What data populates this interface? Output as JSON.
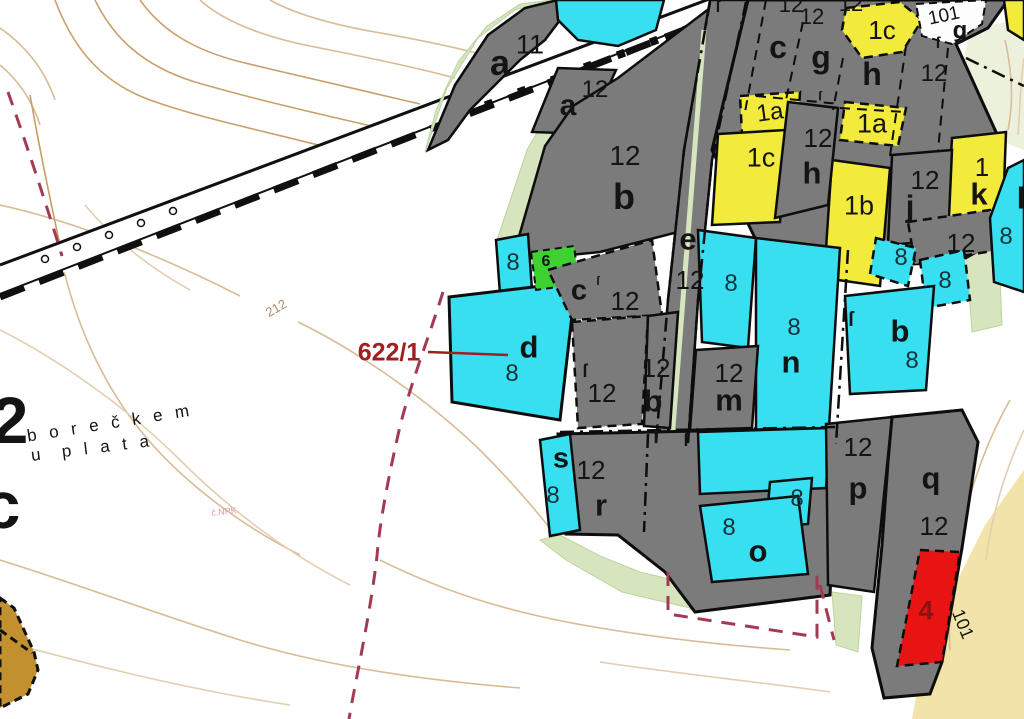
{
  "map": {
    "type": "cadastral-map",
    "callout": {
      "text": "622/1",
      "color": "#9e1f1f"
    },
    "palette": {
      "parcel_gray": "#7b7b7b",
      "parcel_cyan": "#38dff1",
      "parcel_yellow": "#f3eb3b",
      "parcel_green": "#3ed230",
      "parcel_red": "#e81414",
      "parcel_brown": "#c2902e",
      "parcel_white": "#fdfdfd",
      "contour_tan": "#c9a06c",
      "boundary_maroon": "#a23a52",
      "strip_lightgreen": "#d7e5bf",
      "area_paleyellow": "#f2e3a9",
      "number_on_cyan": "#17323c"
    },
    "labels": [
      {
        "name": "parcel-letter-a11",
        "text": "a",
        "x": 500,
        "y": 63,
        "size": 36,
        "w": 700
      },
      {
        "name": "parcel-number-11",
        "text": "11",
        "x": 530,
        "y": 45,
        "size": 27,
        "w": 400
      },
      {
        "name": "parcel-letter-a12",
        "text": "a",
        "x": 568,
        "y": 106,
        "size": 30,
        "w": 700
      },
      {
        "name": "parcel-number-12-a12",
        "text": "12",
        "x": 595,
        "y": 90,
        "size": 24,
        "w": 400
      },
      {
        "name": "parcel-number-12-b-top",
        "text": "12",
        "x": 625,
        "y": 156,
        "size": 28,
        "w": 400
      },
      {
        "name": "parcel-letter-b-top",
        "text": "b",
        "x": 624,
        "y": 197,
        "size": 36,
        "w": 700
      },
      {
        "name": "parcel-letter-c-top",
        "text": "c",
        "x": 778,
        "y": 47,
        "size": 32,
        "w": 700
      },
      {
        "name": "parcel-letter-g-top",
        "text": "g",
        "x": 821,
        "y": 57,
        "size": 32,
        "w": 700
      },
      {
        "name": "parcel-number-12-top-a",
        "text": "12",
        "x": 791,
        "y": 5,
        "size": 22,
        "w": 400
      },
      {
        "name": "parcel-number-12-top-b",
        "text": "12",
        "x": 851,
        "y": 4,
        "size": 22,
        "w": 400
      },
      {
        "name": "parcel-number-12-top-c",
        "text": "12",
        "x": 812,
        "y": 17,
        "size": 22,
        "w": 400
      },
      {
        "name": "parcel-label-1c-top",
        "text": "1c",
        "x": 882,
        "y": 30,
        "size": 26,
        "w": 400
      },
      {
        "name": "parcel-number-101-top",
        "text": "101",
        "x": 944,
        "y": 16,
        "size": 19,
        "w": 400,
        "rot": -12
      },
      {
        "name": "parcel-letter-g-101",
        "text": "g",
        "x": 960,
        "y": 31,
        "size": 24,
        "w": 700
      },
      {
        "name": "parcel-letter-h-top",
        "text": "h",
        "x": 872,
        "y": 74,
        "size": 32,
        "w": 700
      },
      {
        "name": "parcel-number-12-right-top",
        "text": "12",
        "x": 934,
        "y": 74,
        "size": 24,
        "w": 400
      },
      {
        "name": "parcel-label-1a-left",
        "text": "1a",
        "x": 770,
        "y": 113,
        "size": 24,
        "w": 400,
        "rot": -8
      },
      {
        "name": "parcel-number-12-h",
        "text": "12",
        "x": 818,
        "y": 138,
        "size": 26,
        "w": 400
      },
      {
        "name": "parcel-label-1a-right",
        "text": "1a",
        "x": 872,
        "y": 124,
        "size": 27,
        "w": 400
      },
      {
        "name": "parcel-label-1c-mid",
        "text": "1c",
        "x": 761,
        "y": 158,
        "size": 27,
        "w": 400
      },
      {
        "name": "parcel-letter-h-mid",
        "text": "h",
        "x": 812,
        "y": 173,
        "size": 31,
        "w": 700
      },
      {
        "name": "parcel-label-1b",
        "text": "1b",
        "x": 859,
        "y": 206,
        "size": 27,
        "w": 400
      },
      {
        "name": "parcel-number-12-j",
        "text": "12",
        "x": 925,
        "y": 180,
        "size": 26,
        "w": 400
      },
      {
        "name": "parcel-letter-j",
        "text": "j",
        "x": 910,
        "y": 206,
        "size": 31,
        "w": 700
      },
      {
        "name": "parcel-number-1-k",
        "text": "1",
        "x": 982,
        "y": 167,
        "size": 26,
        "w": 400
      },
      {
        "name": "parcel-letter-k",
        "text": "k",
        "x": 979,
        "y": 194,
        "size": 31,
        "w": 700
      },
      {
        "name": "parcel-letter-l",
        "text": "l",
        "x": 1021,
        "y": 198,
        "size": 31,
        "w": 700
      },
      {
        "name": "parcel-number-12-right",
        "text": "12",
        "x": 961,
        "y": 243,
        "size": 26,
        "w": 400
      },
      {
        "name": "parcel-number-8-r1",
        "text": "8",
        "x": 901,
        "y": 258,
        "size": 24,
        "w": 400,
        "color": "#17323c"
      },
      {
        "name": "parcel-number-8-r2",
        "text": "8",
        "x": 945,
        "y": 281,
        "size": 24,
        "w": 400,
        "color": "#17323c"
      },
      {
        "name": "parcel-number-8-edge",
        "text": "8",
        "x": 1006,
        "y": 237,
        "size": 24,
        "w": 400,
        "color": "#17323c"
      },
      {
        "name": "parcel-letter-b-right",
        "text": "b",
        "x": 900,
        "y": 331,
        "size": 31,
        "w": 700
      },
      {
        "name": "parcel-number-8-b-right",
        "text": "8",
        "x": 912,
        "y": 361,
        "size": 24,
        "w": 400,
        "color": "#17323c"
      },
      {
        "name": "parcel-number-8-left",
        "text": "8",
        "x": 513,
        "y": 263,
        "size": 24,
        "w": 400,
        "color": "#17323c"
      },
      {
        "name": "parcel-label-6-green",
        "text": "6",
        "x": 546,
        "y": 262,
        "size": 16,
        "w": 700
      },
      {
        "name": "parcel-letter-c-mid",
        "text": "c",
        "x": 579,
        "y": 291,
        "size": 29,
        "w": 700
      },
      {
        "name": "parcel-number-12-c",
        "text": "12",
        "x": 625,
        "y": 301,
        "size": 26,
        "w": 400
      },
      {
        "name": "parcel-letter-e",
        "text": "e",
        "x": 688,
        "y": 239,
        "size": 31,
        "w": 700
      },
      {
        "name": "parcel-number-12-e",
        "text": "12",
        "x": 690,
        "y": 280,
        "size": 26,
        "w": 400
      },
      {
        "name": "parcel-number-8-e",
        "text": "8",
        "x": 731,
        "y": 284,
        "size": 24,
        "w": 400,
        "color": "#17323c"
      },
      {
        "name": "parcel-number-8-n",
        "text": "8",
        "x": 794,
        "y": 328,
        "size": 24,
        "w": 400,
        "color": "#17323c"
      },
      {
        "name": "parcel-letter-n",
        "text": "n",
        "x": 791,
        "y": 362,
        "size": 31,
        "w": 700
      },
      {
        "name": "parcel-letter-d",
        "text": "d",
        "x": 529,
        "y": 347,
        "size": 31,
        "w": 700
      },
      {
        "name": "parcel-number-8-d",
        "text": "8",
        "x": 512,
        "y": 374,
        "size": 24,
        "w": 400,
        "color": "#17323c"
      },
      {
        "name": "parcel-number-12-g2",
        "text": "12",
        "x": 602,
        "y": 393,
        "size": 26,
        "w": 400
      },
      {
        "name": "parcel-number-12-b-mid",
        "text": "12",
        "x": 656,
        "y": 368,
        "size": 26,
        "w": 400
      },
      {
        "name": "parcel-letter-b-mid",
        "text": "b",
        "x": 653,
        "y": 401,
        "size": 31,
        "w": 700
      },
      {
        "name": "parcel-number-12-m",
        "text": "12",
        "x": 729,
        "y": 373,
        "size": 26,
        "w": 400
      },
      {
        "name": "parcel-letter-m",
        "text": "m",
        "x": 729,
        "y": 400,
        "size": 31,
        "w": 700
      },
      {
        "name": "parcel-number-12-p",
        "text": "12",
        "x": 858,
        "y": 447,
        "size": 26,
        "w": 400
      },
      {
        "name": "parcel-letter-p",
        "text": "p",
        "x": 858,
        "y": 488,
        "size": 31,
        "w": 700
      },
      {
        "name": "parcel-letter-q",
        "text": "q",
        "x": 931,
        "y": 478,
        "size": 31,
        "w": 700
      },
      {
        "name": "parcel-number-12-q",
        "text": "12",
        "x": 934,
        "y": 526,
        "size": 26,
        "w": 400
      },
      {
        "name": "parcel-number-4-red",
        "text": "4",
        "x": 926,
        "y": 611,
        "size": 27,
        "w": 700,
        "color": "#8c1212"
      },
      {
        "name": "parcel-number-101-right",
        "text": "101",
        "x": 963,
        "y": 624,
        "size": 18,
        "w": 400,
        "rot": 68
      },
      {
        "name": "parcel-letter-s",
        "text": "s",
        "x": 561,
        "y": 459,
        "size": 29,
        "w": 700
      },
      {
        "name": "parcel-number-8-s",
        "text": "8",
        "x": 553,
        "y": 496,
        "size": 24,
        "w": 400,
        "color": "#17323c"
      },
      {
        "name": "parcel-number-12-r",
        "text": "12",
        "x": 591,
        "y": 470,
        "size": 26,
        "w": 400
      },
      {
        "name": "parcel-letter-r",
        "text": "r",
        "x": 601,
        "y": 505,
        "size": 31,
        "w": 700
      },
      {
        "name": "parcel-number-8-strip",
        "text": "8",
        "x": 797,
        "y": 499,
        "size": 24,
        "w": 400,
        "color": "#17323c"
      },
      {
        "name": "parcel-number-8-o",
        "text": "8",
        "x": 729,
        "y": 528,
        "size": 24,
        "w": 400,
        "color": "#17323c"
      },
      {
        "name": "parcel-letter-o",
        "text": "o",
        "x": 758,
        "y": 551,
        "size": 31,
        "w": 700
      },
      {
        "name": "contour-label-212",
        "text": "212",
        "x": 276,
        "y": 308,
        "size": 13,
        "w": 400,
        "color": "#b08968",
        "rot": -30
      },
      {
        "name": "callout-622-1",
        "text": "622/1",
        "x": 389,
        "y": 353,
        "size": 25,
        "w": 700,
        "color": "#9e1f1f"
      },
      {
        "name": "edge-number-2",
        "text": "2",
        "x": 10,
        "y": 420,
        "size": 66,
        "w": 700
      },
      {
        "name": "edge-letter-c",
        "text": "c",
        "x": 2,
        "y": 505,
        "size": 66,
        "w": 700
      },
      {
        "name": "place-name-line1",
        "text": "b o r e č k e m",
        "x": 110,
        "y": 423,
        "size": 17,
        "w": 400,
        "rot": -9,
        "ls": 4
      },
      {
        "name": "place-name-line2",
        "text": "u  p l a t a",
        "x": 92,
        "y": 448,
        "size": 17,
        "w": 400,
        "rot": -7,
        "ls": 4
      },
      {
        "name": "note-pink",
        "text": "č.NPK",
        "x": 224,
        "y": 512,
        "size": 9,
        "w": 400,
        "color": "#e398ac",
        "rot": -6
      }
    ],
    "markers": [
      {
        "name": "boundary-marker-1",
        "char": "ſ",
        "x": 585,
        "y": 371,
        "size": 18
      },
      {
        "name": "boundary-marker-2",
        "char": "ſ",
        "x": 656,
        "y": 437,
        "size": 18
      },
      {
        "name": "boundary-marker-3",
        "char": "ſ",
        "x": 686,
        "y": 440,
        "size": 18
      },
      {
        "name": "boundary-marker-4",
        "char": "ſ",
        "x": 851,
        "y": 320,
        "size": 20
      },
      {
        "name": "boundary-marker-5",
        "char": "ſ",
        "x": 938,
        "y": 44,
        "size": 16
      },
      {
        "name": "boundary-marker-6",
        "char": "ſ",
        "x": 718,
        "y": 8,
        "size": 16
      },
      {
        "name": "boundary-marker-7",
        "char": "ſ",
        "x": 820,
        "y": 96,
        "size": 13
      },
      {
        "name": "boundary-marker-8",
        "char": "ſ",
        "x": 598,
        "y": 281,
        "size": 12
      }
    ]
  }
}
